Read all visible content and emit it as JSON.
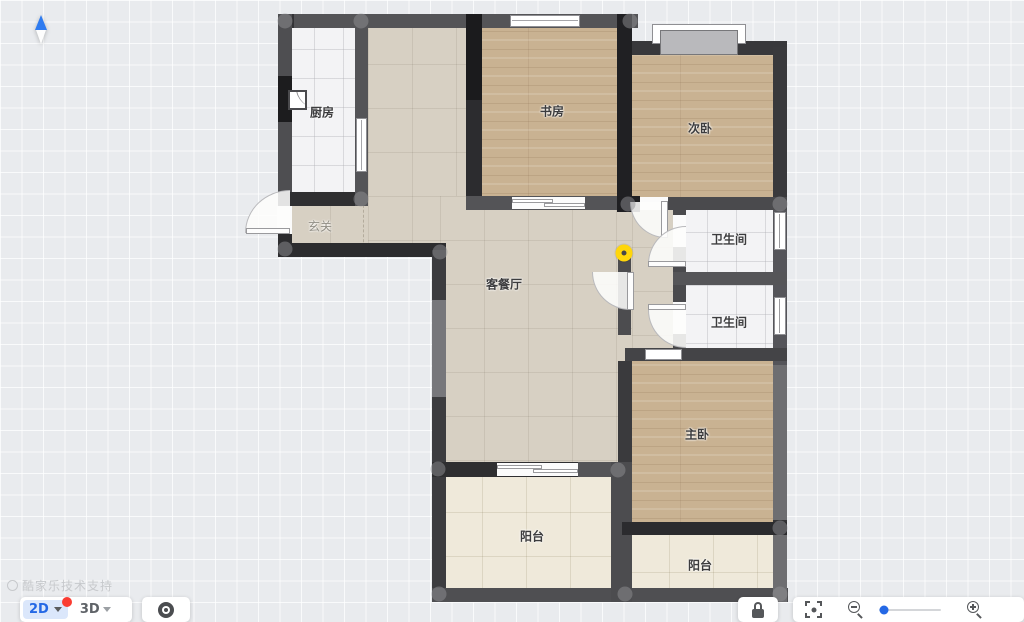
{
  "rooms": {
    "kitchen": {
      "label": "厨房"
    },
    "study": {
      "label": "书房"
    },
    "bedroom2": {
      "label": "次卧"
    },
    "entry": {
      "label": "玄关"
    },
    "living": {
      "label": "客餐厅"
    },
    "bath1": {
      "label": "卫生间"
    },
    "bath2": {
      "label": "卫生间"
    },
    "master": {
      "label": "主卧"
    },
    "balcony_left": {
      "label": "阳台"
    },
    "balcony_right": {
      "label": "阳台"
    }
  },
  "toolbar": {
    "view_2d": "2D",
    "view_3d": "3D",
    "has_2d_notification": true
  },
  "watermark": "酷家乐技术支持",
  "colors": {
    "accent_blue": "#2468e5",
    "notification_red": "#fa3c32",
    "marker_yellow": "#ffd60a",
    "wall_dark": "#2c2c2e",
    "wall_gray": "#4c4c4f"
  }
}
